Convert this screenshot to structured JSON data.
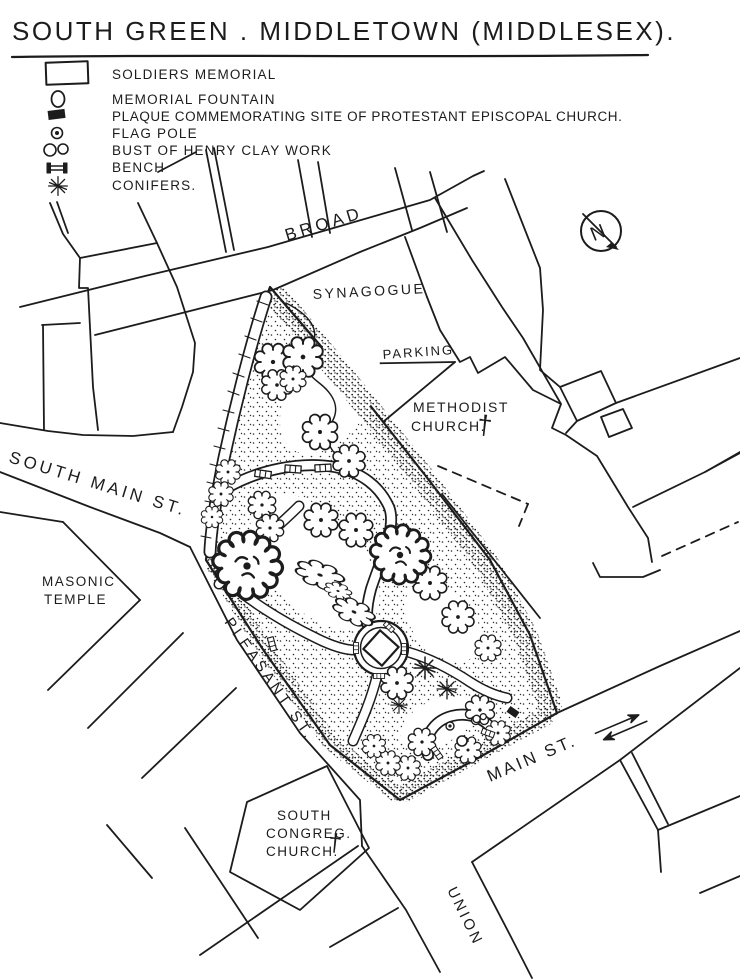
{
  "title": "SOUTH GREEN . MIDDLETOWN (MIDDLESEX).",
  "legend": {
    "items": [
      {
        "symbol": "rectangle-outline",
        "label": "SOLDIERS MEMORIAL"
      },
      {
        "symbol": "circle-outline",
        "label": "MEMORIAL FOUNTAIN"
      },
      {
        "symbol": "filled-square",
        "label": "PLAQUE COMMEMORATING SITE OF PROTESTANT EPISCOPAL CHURCH."
      },
      {
        "symbol": "circle-with-dot",
        "label": "FLAG POLE"
      },
      {
        "symbol": "figure-eight",
        "label": "BUST OF HENRY CLAY WORK"
      },
      {
        "symbol": "bench-icon",
        "label": "BENCH"
      },
      {
        "symbol": "asterisk-star",
        "label": "CONIFERS."
      }
    ]
  },
  "map": {
    "streets": {
      "broad": "BROAD",
      "south_main": "SOUTH MAIN ST.",
      "pleasant": "PLEASANT ST.",
      "main": "MAIN ST.",
      "union": "UNION"
    },
    "places": {
      "synagogue": "SYNAGOGUE",
      "parking": "PARKING",
      "methodist_line1": "METHODIST",
      "methodist_line2": "CHURCH.",
      "masonic_line1": "MASONIC",
      "masonic_line2": "TEMPLE",
      "congreg_line1": "SOUTH",
      "congreg_line2": "CONGREG.",
      "congreg_line3": "CHURCH."
    },
    "compass_letter": "N",
    "cross_glyph": "†"
  },
  "colors": {
    "ink": "#1c1c1c",
    "paper": "#ffffff"
  }
}
